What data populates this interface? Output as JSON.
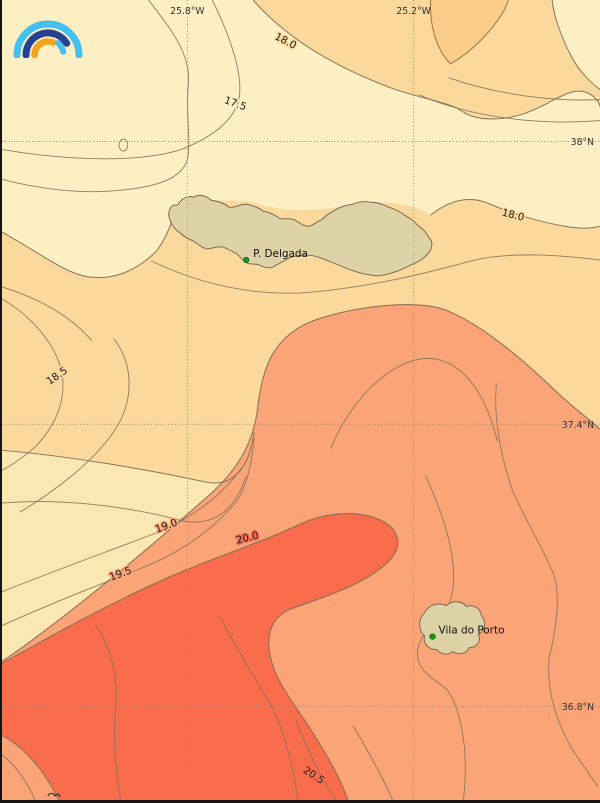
{
  "map": {
    "type": "filled-contour-temperature-map",
    "contour_levels": [
      17.5,
      18.0,
      18.5,
      19.0,
      19.5,
      20.0,
      20.5
    ],
    "grid": {
      "meridians": [
        {
          "label": "25.8°W",
          "x": 186
        },
        {
          "label": "25.2°W",
          "x": 413
        }
      ],
      "parallels": [
        {
          "label": "38°N",
          "y": 142
        },
        {
          "label": "37.4°N",
          "y": 426
        },
        {
          "label": "36.8°N",
          "y": 709
        }
      ]
    },
    "contour_labels": [
      {
        "text": "18.0",
        "x": 283,
        "y": 44,
        "rot": 28,
        "halo": "band_light"
      },
      {
        "text": "17.5",
        "x": 233,
        "y": 107,
        "rot": 20,
        "halo": "cream"
      },
      {
        "text": "18.0",
        "x": 512,
        "y": 219,
        "rot": 14,
        "halo": "band_light"
      },
      {
        "text": "18.5",
        "x": 57,
        "y": 380,
        "rot": -35,
        "halo": "band_light"
      },
      {
        "text": "19.0",
        "x": 166,
        "y": 531,
        "rot": -20,
        "halo": "salmon"
      },
      {
        "text": "20.0",
        "x": 247,
        "y": 543,
        "rot": -14,
        "halo": "red"
      },
      {
        "text": "19.5",
        "x": 120,
        "y": 579,
        "rot": -20,
        "halo": "salmon"
      },
      {
        "text": "20.5",
        "x": 311,
        "y": 781,
        "rot": 33,
        "halo": "red"
      }
    ],
    "places": [
      {
        "name": "P. Delgada",
        "dot_x": 245,
        "dot_y": 261,
        "label_x": 252,
        "label_y": 258
      },
      {
        "name": "Vila do Porto",
        "dot_x": 432,
        "dot_y": 639,
        "label_x": 438,
        "label_y": 636
      }
    ],
    "palette": {
      "cream": "#fcefc3",
      "band_light": "#fbd99d",
      "band_core": "#f8cd89",
      "band_pale": "#fbe7b2",
      "salmon": "#fba477",
      "red": "#f96c4c",
      "island": "#ded3a7",
      "contour_line": "#84735a",
      "grid_line": "#8f877d",
      "artifact_salmon": "#f58a5e",
      "artifact_red": "#ef5a3a",
      "city_dot": "#18a018",
      "city_dot_edge": "#0a650a"
    }
  },
  "logo": {
    "name": "rainbow-arcs-logo",
    "colors": {
      "outer_arc": "#45bfee",
      "middle_arc": "#26418f",
      "inner_left_arc": "#f6a31d",
      "inner_right_arc": "#45bfee"
    }
  }
}
